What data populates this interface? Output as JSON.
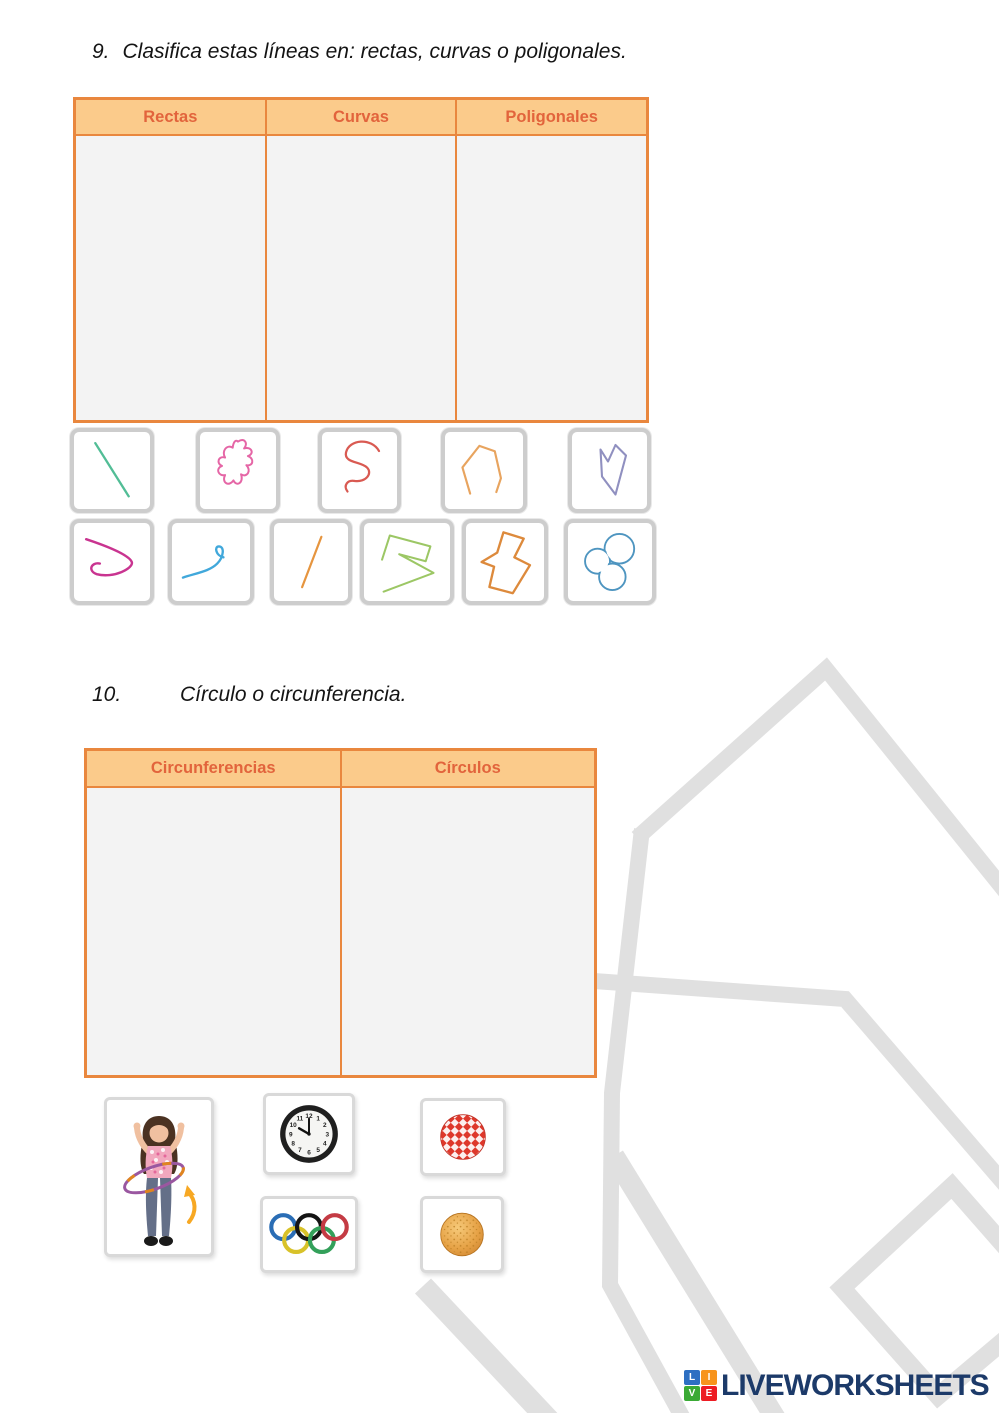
{
  "page": {
    "background": "#FFFFFF"
  },
  "watermark": {
    "name": "liveworksheets-house-outline",
    "color": "#E0E0E0"
  },
  "exercise9": {
    "number": "9.",
    "title": "Clasifica estas líneas en: rectas, curvas o poligonales.",
    "table": {
      "headers": [
        "Rectas",
        "Curvas",
        "Poligonales"
      ],
      "header_bg": "#FBCB8B",
      "header_text_color": "#E2643C",
      "border_color": "#E9873E",
      "cell_bg": "#F3F3F3"
    },
    "shapes": [
      {
        "name": "straight-line-green",
        "color": "#52BD96"
      },
      {
        "name": "curvy-blob-pink",
        "color": "#E566A6"
      },
      {
        "name": "s-curve-red",
        "color": "#D95A52"
      },
      {
        "name": "open-polyline-orange",
        "color": "#E8A45F"
      },
      {
        "name": "closed-polygon-slate",
        "color": "#9090C0"
      },
      {
        "name": "loop-curve-magenta",
        "color": "#C93490"
      },
      {
        "name": "hook-curve-blue",
        "color": "#41A8DB"
      },
      {
        "name": "straight-line-orange",
        "color": "#E6953F"
      },
      {
        "name": "zigzag-polyline-green",
        "color": "#9CC765"
      },
      {
        "name": "closed-polygon-orange",
        "color": "#DD8A3C"
      },
      {
        "name": "cloud-curve-blue",
        "color": "#4E95C0"
      }
    ]
  },
  "exercise10": {
    "number": "10.",
    "title": "Círculo o circunferencia.",
    "table": {
      "headers": [
        "Circunferencias",
        "Círculos"
      ]
    },
    "images": [
      {
        "name": "girl-with-hula-hoop"
      },
      {
        "name": "wall-clock",
        "numbers": [
          "12",
          "1",
          "2",
          "3",
          "4",
          "5",
          "6",
          "7",
          "8",
          "9",
          "10",
          "11"
        ]
      },
      {
        "name": "red-gingham-circle"
      },
      {
        "name": "olympic-rings"
      },
      {
        "name": "round-cookie"
      }
    ]
  },
  "branding": {
    "logo_text": "LIVEWORKSHEETS",
    "logo_text_color": "#1C3A69",
    "logo_squares": [
      {
        "letter": "L",
        "color": "#2D6FC2"
      },
      {
        "letter": "I",
        "color": "#F7941D"
      },
      {
        "letter": "V",
        "color": "#3AAA35"
      },
      {
        "letter": "E",
        "color": "#ED1C24"
      }
    ]
  }
}
